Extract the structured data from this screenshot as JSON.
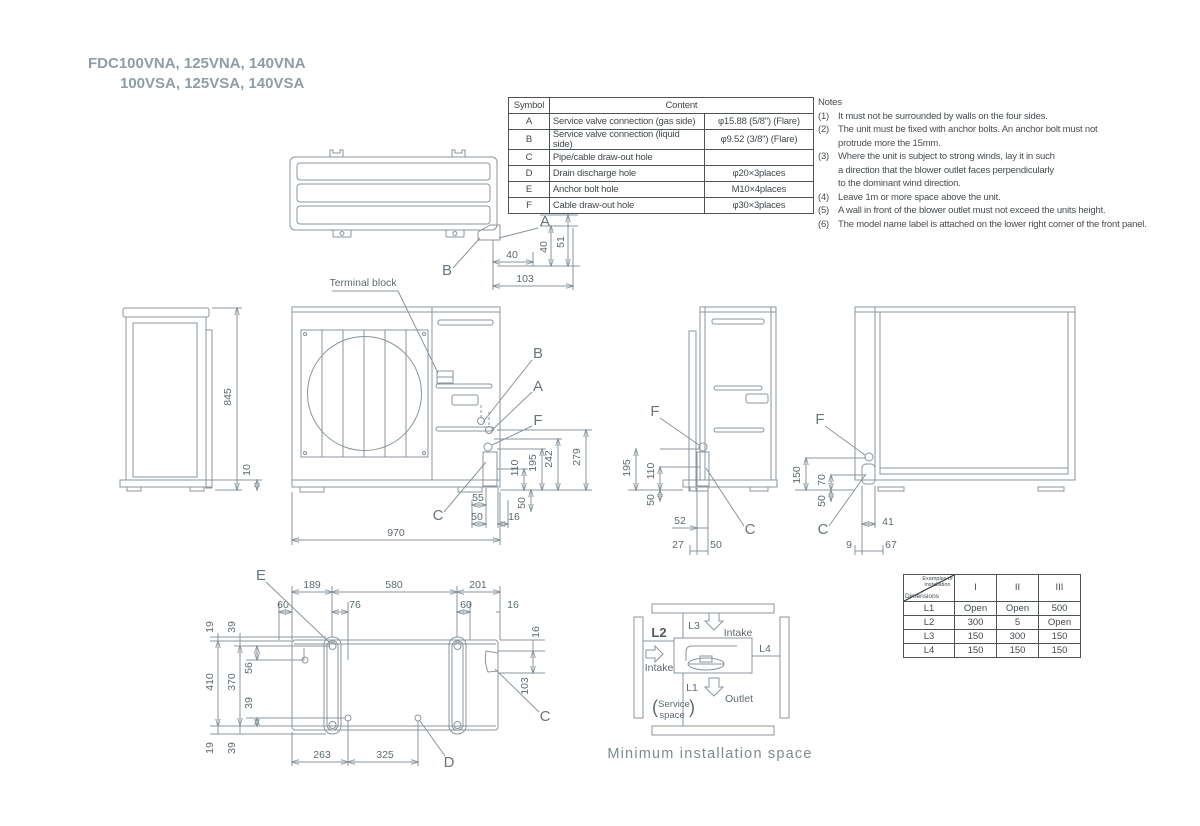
{
  "title": {
    "line1": "FDC100VNA, 125VNA, 140VNA",
    "line2": "100VSA, 125VSA, 140VSA"
  },
  "symbol_table": {
    "col_symbol": "Symbol",
    "col_content": "Content",
    "rows": [
      {
        "s": "A",
        "c": "Service valve connection (gas side)",
        "v": "φ15.88 (5/8\") (Flare)"
      },
      {
        "s": "B",
        "c": "Service valve connection (liquid side)",
        "v": "φ9.52 (3/8\") (Flare)"
      },
      {
        "s": "C",
        "c": "Pipe/cable draw-out hole",
        "v": ""
      },
      {
        "s": "D",
        "c": "Drain discharge hole",
        "v": "φ20×3places"
      },
      {
        "s": "E",
        "c": "Anchor bolt hole",
        "v": "M10×4places"
      },
      {
        "s": "F",
        "c": "Cable draw-out hole",
        "v": "φ30×3places"
      }
    ]
  },
  "notes": {
    "heading": "Notes",
    "items": [
      {
        "n": "(1)",
        "t": "It must not be surrounded by walls on the four sides."
      },
      {
        "n": "(2)",
        "t": "The unit must be fixed with anchor bolts. An anchor bolt must not\nprotrude more the 15mm."
      },
      {
        "n": "(3)",
        "t": "Where the unit is subject to strong winds, lay it in such\na direction that the blower outlet faces perpendicularly\nto the dominant wind direction."
      },
      {
        "n": "(4)",
        "t": "Leave 1m or more space above the unit."
      },
      {
        "n": "(5)",
        "t": "A wall in front of the blower outlet must not exceed the units height."
      },
      {
        "n": "(6)",
        "t": "The model name label is attached on the lower right corner of the front panel."
      }
    ]
  },
  "labels": {
    "A": "A",
    "B": "B",
    "C": "C",
    "D": "D",
    "E": "E",
    "F": "F"
  },
  "annotations": {
    "terminal_block": "Terminal block"
  },
  "dims": {
    "top": {
      "d40h": "40",
      "d103": "103",
      "d40v": "40",
      "d51": "51"
    },
    "left": {
      "d845": "845",
      "d10": "10"
    },
    "front": {
      "d970": "970",
      "d110": "110",
      "d195": "195",
      "d242": "242",
      "d279": "279",
      "d50v": "50",
      "d55": "55",
      "d50h": "50",
      "d16": "16"
    },
    "side": {
      "d195": "195",
      "d110": "110",
      "d50v": "50",
      "d52": "52",
      "d27": "27",
      "d50h": "50"
    },
    "back": {
      "d150": "150",
      "d70": "70",
      "d50v": "50",
      "d41": "41",
      "d9": "9",
      "d67": "67"
    },
    "bottom": {
      "d189": "189",
      "d580": "580",
      "d201": "201",
      "d60a": "60",
      "d76": "76",
      "d60b": "60",
      "d16a": "16",
      "d19t": "19",
      "d39t": "39",
      "d410": "410",
      "d370": "370",
      "d56": "56",
      "d39m": "39",
      "d19b": "19",
      "d39b": "39",
      "d263": "263",
      "d325": "325",
      "d16r": "16",
      "d103": "103"
    }
  },
  "install": {
    "l1": "L1",
    "l2": "L2",
    "l3": "L3",
    "l4": "L4",
    "intake_top": "Intake",
    "intake_left": "Intake",
    "outlet": "Outlet",
    "paren_open": "(",
    "paren_close": ")",
    "service_line1": "Service",
    "service_line2": "space",
    "caption": "Minimum installation space"
  },
  "install_table": {
    "corner_top": "Examples of installation",
    "corner_bottom": "Dimensions",
    "cols": [
      "I",
      "II",
      "III"
    ],
    "rows": [
      {
        "name": "L1",
        "v": [
          "Open",
          "Open",
          "500"
        ]
      },
      {
        "name": "L2",
        "v": [
          "300",
          "5",
          "Open"
        ]
      },
      {
        "name": "L3",
        "v": [
          "150",
          "300",
          "150"
        ]
      },
      {
        "name": "L4",
        "v": [
          "150",
          "150",
          "150"
        ]
      }
    ]
  }
}
